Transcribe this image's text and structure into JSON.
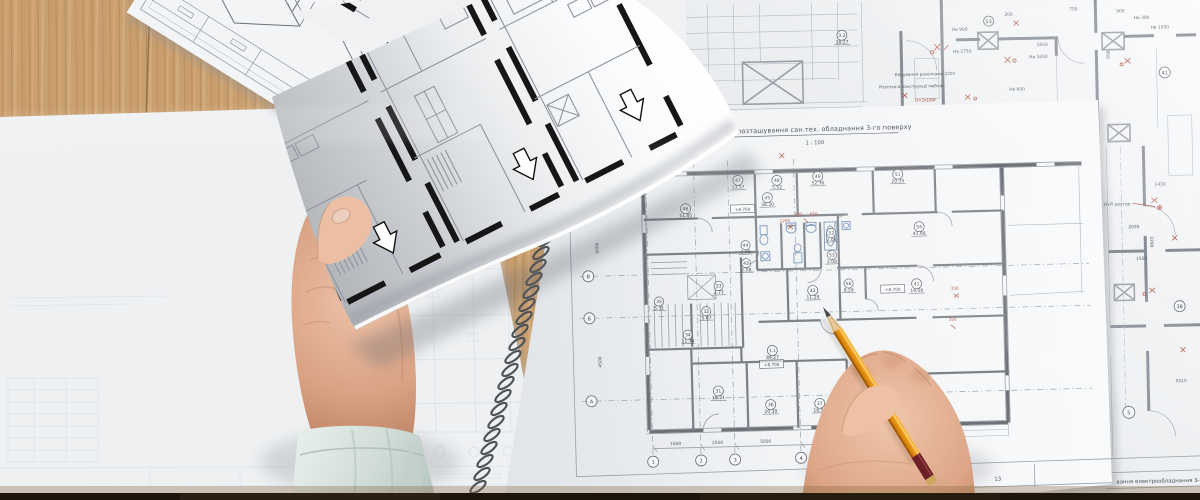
{
  "scene": {
    "description": "Top-down photo of architect's desk: hands holding a floor-plan sheet and a pencil over a spiral-bound sanitary-equipment plan, more blueprints on a wooden desk",
    "colors": {
      "wood": "#cda272",
      "wood_dark": "#a87f4e",
      "paper": "#f2f3f5",
      "plan_wall": "#6d7278",
      "black_wall": "#161616",
      "annotation_red": "#b0493c",
      "fixture_blue": "#7391b8",
      "skin": "#d9a585",
      "sleeve": "#d5dfda"
    }
  },
  "notebook": {
    "title": "План розташування сан.тех. обладнання 3-го поверху",
    "scale": "1 : 100",
    "elevation": "+8.700",
    "axes": {
      "letters": [
        "В",
        "Б",
        "А"
      ],
      "numbers": [
        "1",
        "2",
        "3",
        "4"
      ]
    },
    "rooms": [
      {
        "id": "46",
        "area": "51.85"
      },
      {
        "id": "47",
        "area": "13.57"
      },
      {
        "id": "48",
        "area": "5.52"
      },
      {
        "id": "49",
        "area": "52.76"
      },
      {
        "id": "51",
        "area": "20.35"
      },
      {
        "id": "45",
        "area": "38.30"
      },
      {
        "id": "44",
        "area": "2.08"
      },
      {
        "id": "43",
        "area": "2.18"
      },
      {
        "id": "52",
        "area": "2.08"
      },
      {
        "id": "53",
        "area": "2.08"
      },
      {
        "id": "54",
        "area": "42.68"
      },
      {
        "id": "56",
        "area": "8.29"
      },
      {
        "id": "42",
        "area": "11.29"
      },
      {
        "id": "41",
        "area": "19.08"
      },
      {
        "id": "35",
        "area": "5.31"
      },
      {
        "id": "33",
        "area": "2.77"
      },
      {
        "id": "32",
        "area": "5.87"
      },
      {
        "id": "34",
        "area": "11.74"
      },
      {
        "id": "3.1",
        "area": "84.27"
      },
      {
        "id": "31",
        "area": "18.21"
      },
      {
        "id": "36",
        "area": "20.39"
      },
      {
        "id": "37",
        "area": "16.57"
      }
    ],
    "dims_bottom": [
      "1600",
      "2500",
      "5000",
      "5000"
    ],
    "dims_side": [
      "6000",
      "4500"
    ],
    "red_dims": [
      "1200",
      "635",
      "655",
      "350",
      "350"
    ],
    "titleblock": {
      "left": "го поверху",
      "sheet": "13"
    }
  },
  "electrical": {
    "titleblock": "вання електрообладнання 3-го по",
    "labels": {
      "wifi": "Wi-Fi роутер",
      "socket_control": "Керування розетками 220V",
      "socket_furniture": "Розетки в конструкції меблів",
      "lamp": "О=2х18W"
    },
    "room": {
      "id": "3.2",
      "area": "18.27"
    },
    "grid_circles": [
      "53",
      "41",
      "38",
      "5"
    ],
    "dims": [
      "200",
      "750",
      "900",
      "1650",
      "950",
      "1430",
      "1550",
      "2200",
      "2035",
      "5010"
    ],
    "mount_heights": [
      "Нв 900",
      "Нв 300",
      "Нв 1050",
      "Нв 2750",
      "Нв 1650",
      "Нв 600"
    ]
  },
  "pencil": {
    "body_color": "#ef9f18",
    "band_color": "#6d2026"
  }
}
